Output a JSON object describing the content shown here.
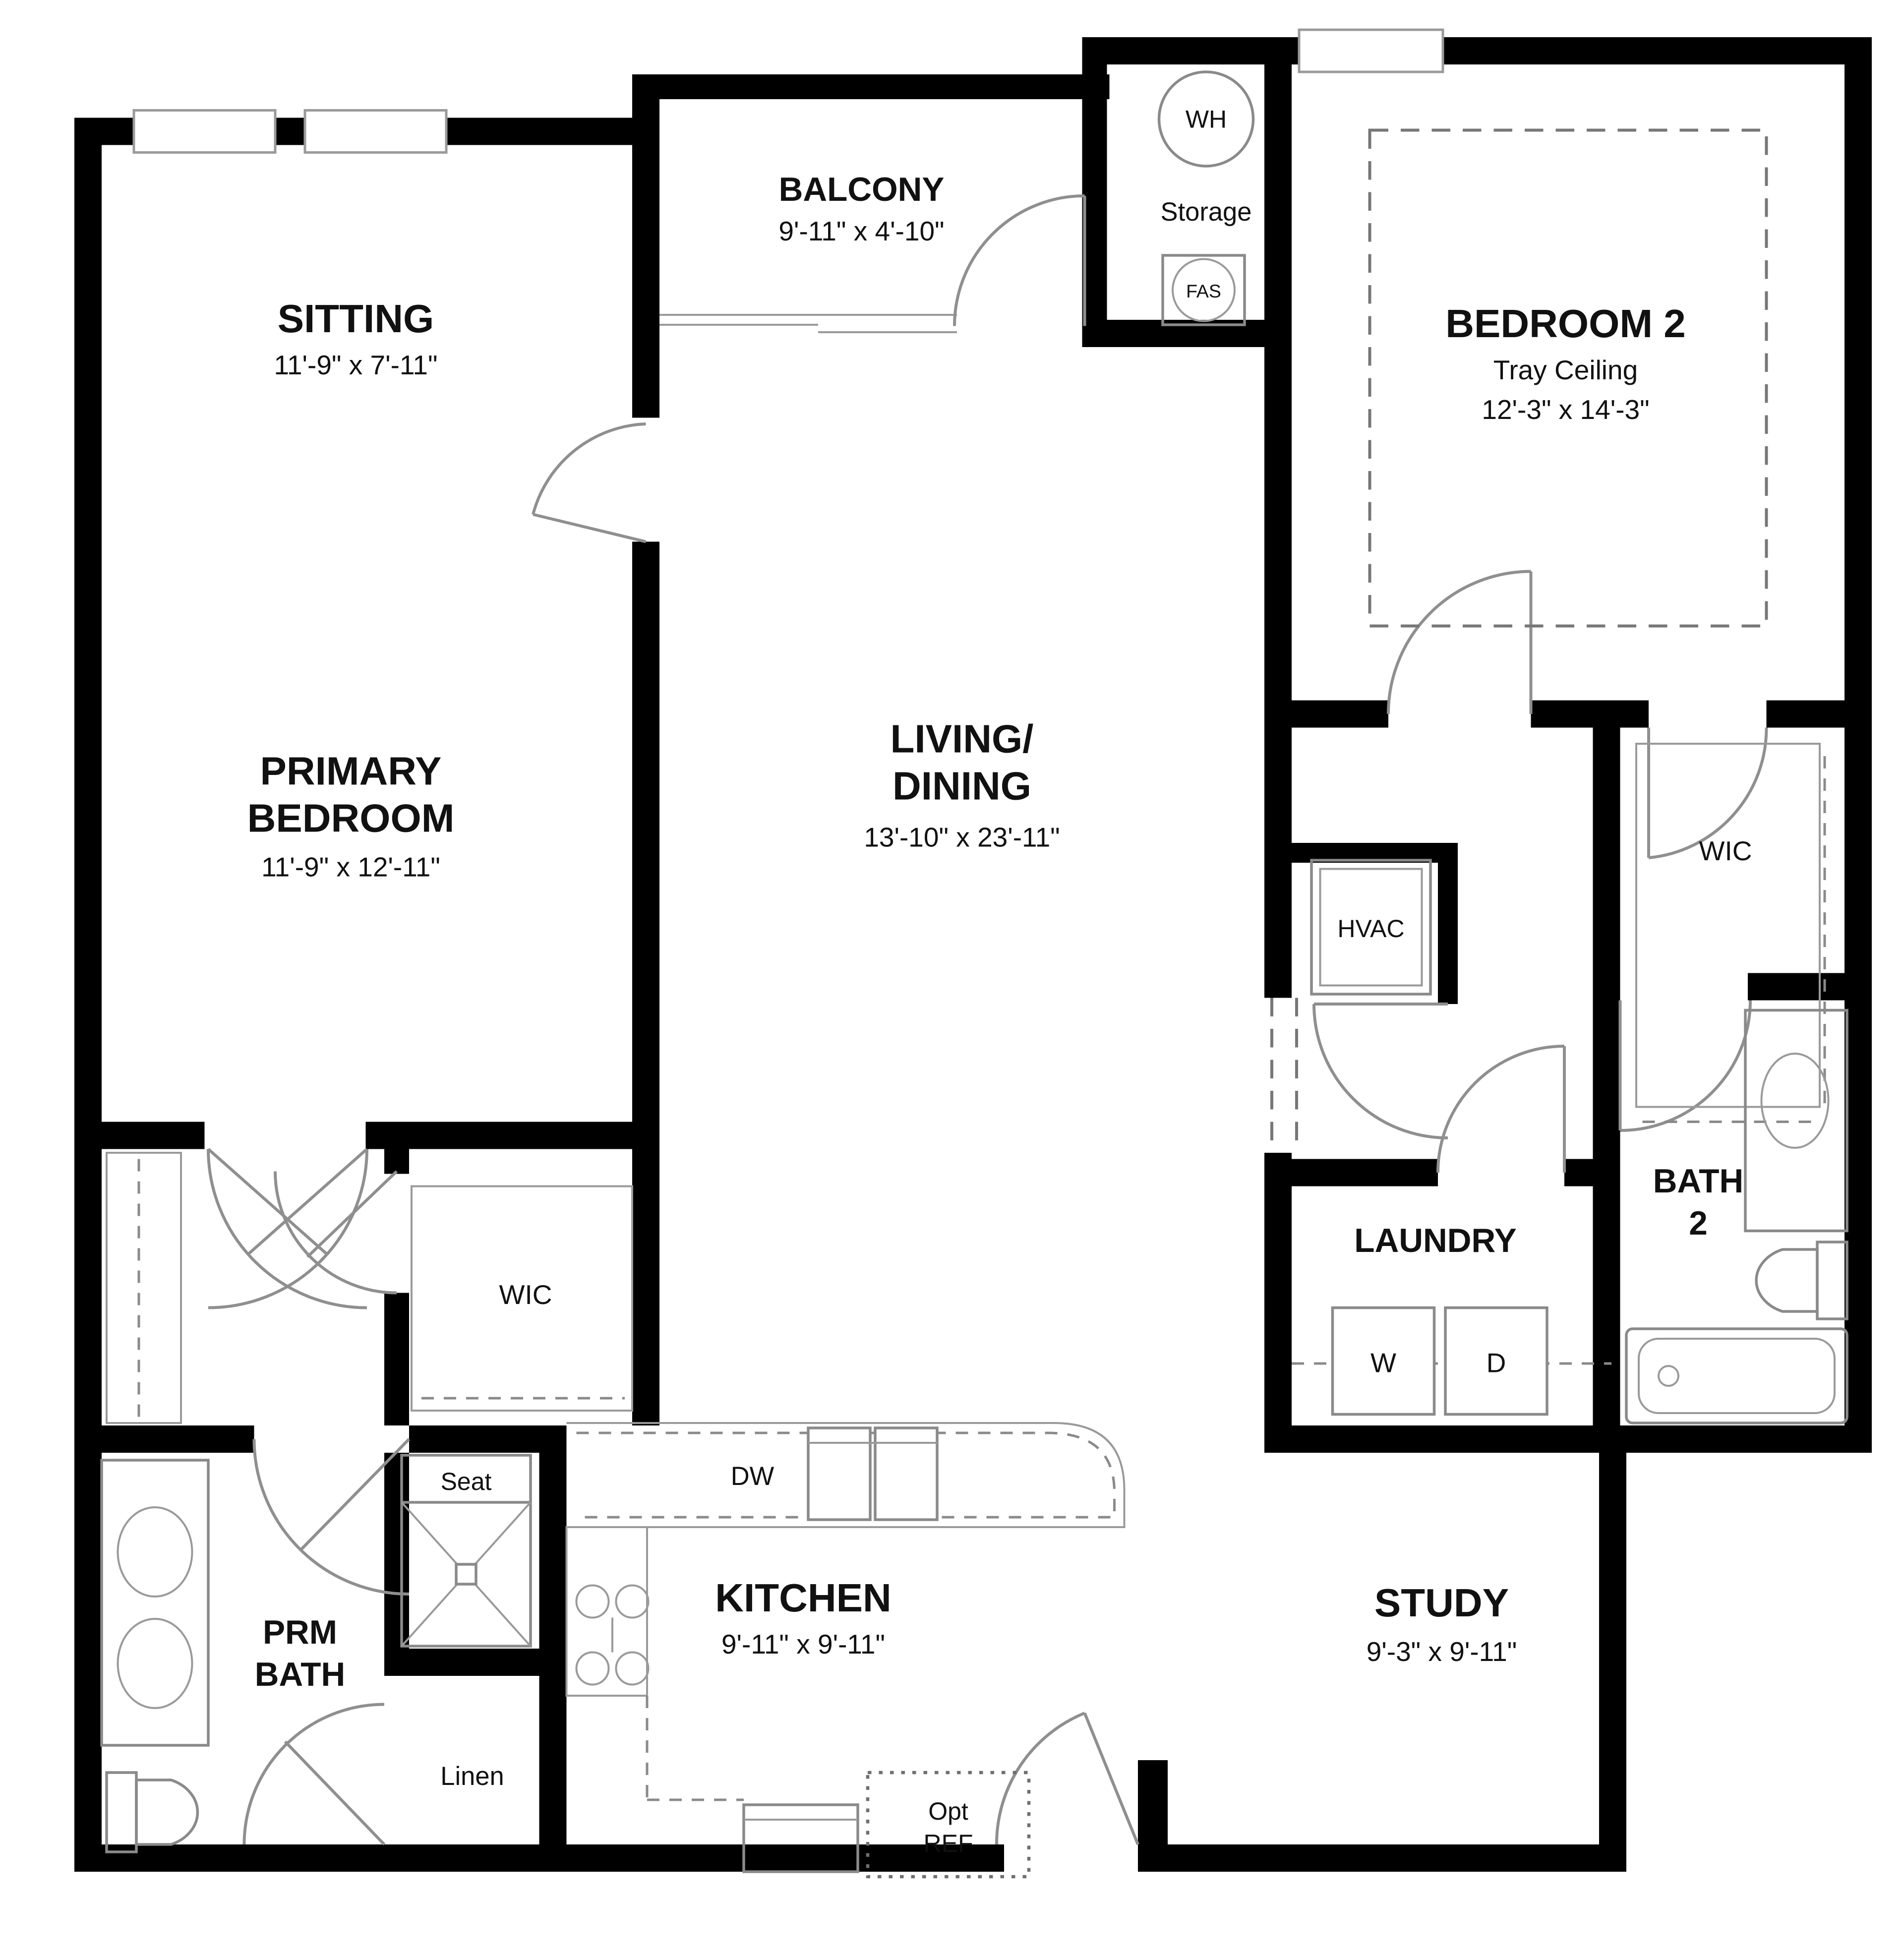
{
  "colors": {
    "wall": "#000000",
    "fixture_line": "#8a8a8a",
    "dashed_line": "#777777",
    "text": "#111111",
    "background": "#ffffff"
  },
  "rooms": {
    "sitting": {
      "name": "SITTING",
      "dims": "11'-9\" x 7'-11\""
    },
    "balcony": {
      "name": "BALCONY",
      "dims": "9'-11\" x 4'-10\""
    },
    "storage": {
      "name": "Storage"
    },
    "bedroom2": {
      "name": "BEDROOM 2",
      "ceiling": "Tray Ceiling",
      "dims": "12'-3\" x 14'-3\""
    },
    "primary_bedroom": {
      "name_line1": "PRIMARY",
      "name_line2": "BEDROOM",
      "dims": "11'-9\" x 12'-11\""
    },
    "living_dining": {
      "name_line1": "LIVING/",
      "name_line2": "DINING",
      "dims": "13'-10\" x 23'-11\""
    },
    "wic_primary": {
      "name": "WIC"
    },
    "wic_bedroom2": {
      "name": "WIC"
    },
    "hvac_closet": {
      "name": "HVAC"
    },
    "laundry": {
      "name": "LAUNDRY"
    },
    "bath2": {
      "name_line1": "BATH",
      "name_line2": "2"
    },
    "primary_bath": {
      "name_line1": "PRM",
      "name_line2": "BATH"
    },
    "kitchen": {
      "name": "KITCHEN",
      "dims": "9'-11\" x 9'-11\""
    },
    "study": {
      "name": "STUDY",
      "dims": "9'-3\" x 9'-11\""
    }
  },
  "fixtures": {
    "water_heater": "WH",
    "fresh_air_system": "FAS",
    "dishwasher": "DW",
    "washer": "W",
    "dryer": "D",
    "shower_seat": "Seat",
    "linen": "Linen",
    "opt_ref_line1": "Opt",
    "opt_ref_line2": "REF"
  }
}
